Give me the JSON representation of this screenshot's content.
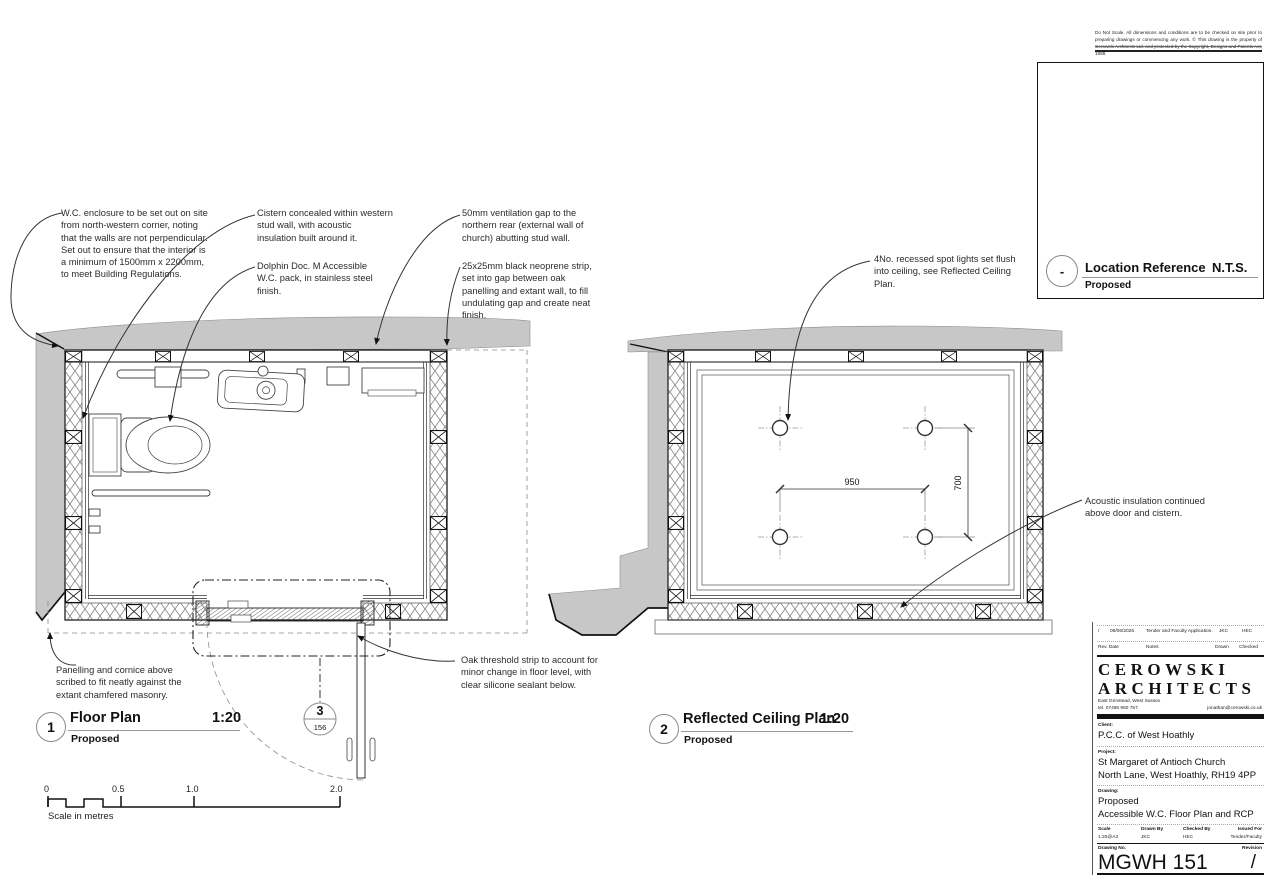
{
  "annotations": {
    "wc_enclosure": "W.C. enclosure to be set out on site from north-western corner, noting that the walls are not perpendicular.  Set out to ensure that the interior is a minimum of 1500mm x 2200mm, to meet Building Regulations.",
    "cistern": "Cistern concealed within western stud wall, with acoustic insulation built around it.",
    "dolphin": "Dolphin Doc. M Accessible W.C. pack, in stainless steel finish.",
    "ventilation": "50mm ventilation gap to the northern rear (external wall of church) abutting stud wall.",
    "neoprene": "25x25mm black neoprene strip, set into gap between oak panelling and extant wall, to fill undulating gap and create neat finish.",
    "spotlights": "4No. recessed spot lights set flush into ceiling, see Reflected Ceiling Plan.",
    "acoustic": "Acoustic insulation continued above door and cistern.",
    "panelling": "Panelling and cornice above scribed to fit neatly against the extant chamfered masonry.",
    "oak_threshold": "Oak threshold strip to account for minor change in floor level, with clear silicone sealant below."
  },
  "floor_plan": {
    "number": "1",
    "title": "Floor Plan",
    "scale": "1:20",
    "subtitle": "Proposed",
    "section": {
      "number": "3",
      "sheet": "156"
    }
  },
  "rcp": {
    "number": "2",
    "title": "Reflected Ceiling Plan",
    "scale": "1:20",
    "subtitle": "Proposed",
    "dim_horizontal": "950",
    "dim_vertical": "700"
  },
  "scale_bar": {
    "labels": [
      "0",
      "0.5",
      "1.0",
      "2.0"
    ],
    "caption": "Scale in metres"
  },
  "location": {
    "marker": "-",
    "title": "Location Reference",
    "scale": "N.T.S.",
    "subtitle": "Proposed",
    "labels": {
      "wc": "W.C.",
      "tower": "Tower",
      "cupboard": "C'brd",
      "sunday1": "Sunday",
      "sunday2": "School",
      "vestry": "Vestry",
      "nave": "Na",
      "south": "South",
      "north": "N"
    }
  },
  "disclaimer": "Do Not Scale. All dimensions and conditions are to be checked on site prior to preparing drawings or commencing any work. © This drawing is the property of Cerowski Architects Ltd. and protected by the Copyright, Designs and Patents Act, 1988.",
  "title_block": {
    "rev": {
      "rev": "/",
      "date": "06/06/2025",
      "notes": "Tender and Faculty Application.",
      "drawn": "JKC",
      "checked": "HEC",
      "h_rev_date": "Rev. Date",
      "h_notes": "Notes",
      "h_drawn": "Drawn",
      "h_checked": "Checked"
    },
    "practice": {
      "line1": "CEROWSKI",
      "line2": "ARCHITECTS",
      "address": "East Grinstead, West Sussex",
      "tel": "tel. 07495 960 757",
      "email": "jonathan@cerowski.co.uk"
    },
    "client_label": "Client:",
    "client": "P.C.C. of West Hoathly",
    "project_label": "Project:",
    "project1": "St Margaret of Antioch Church",
    "project2": "North Lane, West Hoathly, RH19 4PP",
    "drawing_label": "Drawing:",
    "drawing1": "Proposed",
    "drawing2": "Accessible W.C. Floor Plan and RCP",
    "scale_label": "Scale",
    "scale": "1:20@A3",
    "drawnby_label": "Drawn By",
    "drawnby": "JKC",
    "checkedby_label": "Checked By",
    "checkedby": "HEC",
    "issued_label": "Issued For",
    "issued": "Tender/Faculty",
    "no_label": "Drawing No.",
    "number": "MGWH 151",
    "revision_label": "Revision",
    "revision": "/"
  }
}
